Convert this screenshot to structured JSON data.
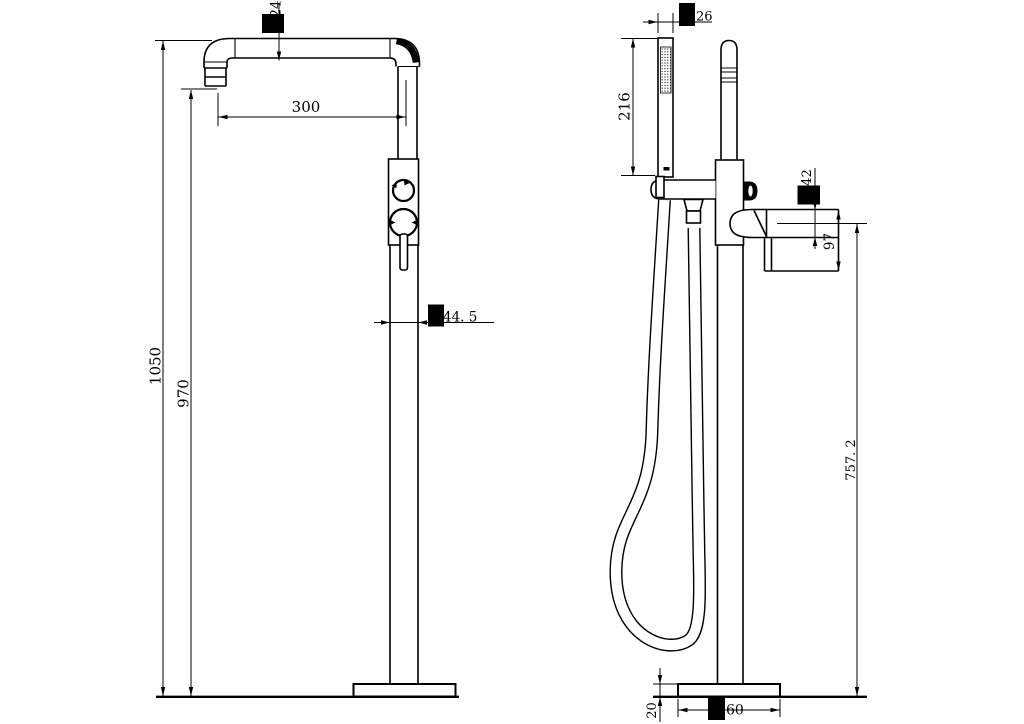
{
  "style": {
    "background": "#ffffff",
    "line_color": "#000000",
    "text_color": "#000000",
    "redaction_color": "#000000"
  },
  "front_view": {
    "dims": {
      "spout_tube_diameter": "24",
      "spout_reach": "300",
      "overall_height": "1050",
      "spout_outlet_height": "970",
      "column_diameter": "44. 5"
    }
  },
  "side_view": {
    "dims": {
      "hand_shower_diameter": "26",
      "hand_shower_length": "216",
      "spout_diameter": "42",
      "spout_drop": "97",
      "spout_height_from_floor": "757. 2",
      "base_thickness": "20",
      "base_diameter_visible": "60"
    }
  }
}
